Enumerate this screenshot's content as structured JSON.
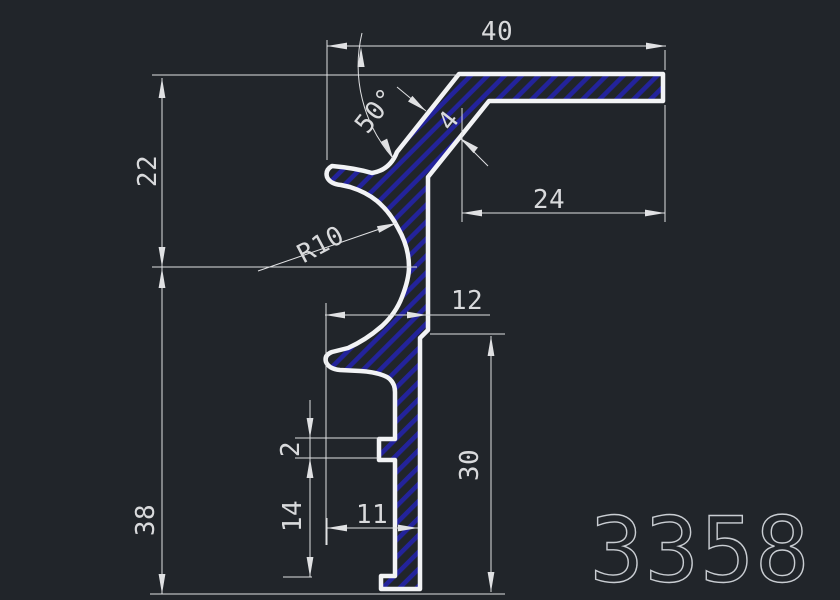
{
  "canvas": {
    "background_color": "#21252a",
    "kind": "cad-profile-drawing"
  },
  "profile": {
    "outline_color": "#f2f3f5",
    "hatch_color": "#23239b"
  },
  "dimensions": {
    "line_color": "#e0e1e3",
    "text_color": "#d9dadc",
    "top_width": "40",
    "corner_angle": "50°",
    "wall_thickness": "4",
    "upper_height": "22",
    "top_arm_length": "24",
    "fillet_radius": "R10",
    "mid_width": "12",
    "lower_height": "38",
    "notch_height": "2",
    "right_height": "30",
    "foot_section_height": "14",
    "bottom_width": "11"
  },
  "title_block": {
    "drawing_number": "3358",
    "color": "#c9cdd2"
  }
}
